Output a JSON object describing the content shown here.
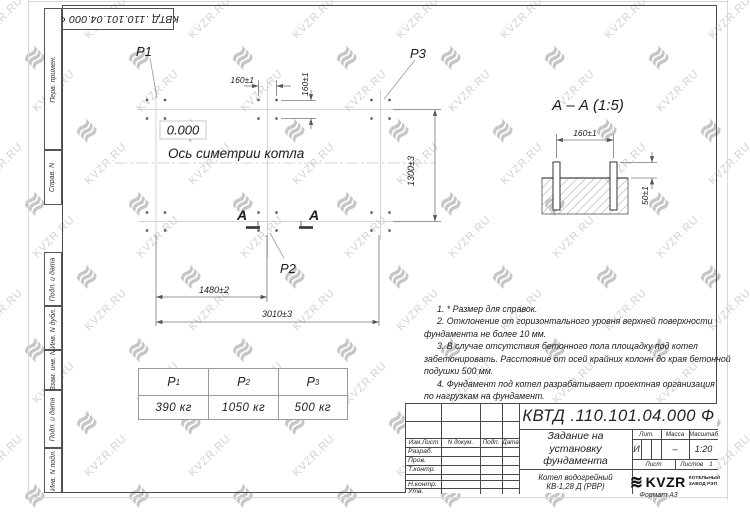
{
  "colors": {
    "line": "#4a4a4a",
    "watermark_text": "#d2d2d2",
    "watermark_logo": "#c6c6c6"
  },
  "watermark": {
    "text": "KVZR.RU",
    "logo_glyph": "≋"
  },
  "frame": {
    "left_labels": [
      "Перв. примен.",
      "Справ. N",
      "Подп. и дата",
      "Инв. N дубл.",
      "Взам. инв. N",
      "Подп. и дата",
      "Инв. N подл."
    ],
    "format_label": "Формат А3"
  },
  "plan": {
    "level_mark": "0.000",
    "axis_label": "Ось симетрии котла",
    "p1": "P1",
    "p2": "P2",
    "p3": "P3",
    "section_letter": "А",
    "dims": {
      "bolt_h": "160±1",
      "bolt_v": "160±1",
      "width_part": "1480±2",
      "width_total": "3010±3",
      "height_total": "1300±3"
    }
  },
  "section": {
    "title": "А – А (1:5)",
    "dims": {
      "bolt_spacing": "160±1",
      "bolt_height": "50±1"
    }
  },
  "notes": {
    "lines": [
      "1. * Размер для справок.",
      "2. Отклонение от горизонтального уровня верхней поверхности",
      "фундамента не более 10 мм.",
      "3. В случае отсутствия бетонного пола площадку под котел",
      "забетонировать. Расстояние от осей крайних колонн до края бетонной",
      "подушки 500 мм.",
      "4. Фундамент под котел разрабатывает проектная организация",
      "по нагрузкам на фундамент."
    ]
  },
  "loads": {
    "columns": [
      {
        "head": "P",
        "sub": "1",
        "value": "390 кг"
      },
      {
        "head": "P",
        "sub": "2",
        "value": "1050 кг"
      },
      {
        "head": "P",
        "sub": "3",
        "value": "500 кг"
      }
    ]
  },
  "titleblock": {
    "number": "КВТД .110.101.04.000  Ф",
    "header_cols": [
      "Изм.Лист",
      "N докум.",
      "Подп.",
      "Дата"
    ],
    "row_labels": [
      "Разраб.",
      "Пров.",
      "Т.контр.",
      "",
      "Н.контр.",
      "Утв."
    ],
    "title_lines": [
      "Задание на",
      "установку",
      "фундамента"
    ],
    "product_lines": [
      "Котел водогрейный",
      "КВ-1,28 Д (РВР)"
    ],
    "lit_label": "Лит.",
    "mass_label": "Масса",
    "scale_label": "Масштаб",
    "lit_value": "И",
    "mass_value": "–",
    "scale_value": "1:20",
    "sheet_label": "Лист",
    "sheets_label": "Листов",
    "sheets_value": "1",
    "logo_text": "KVZR",
    "logo_line1": "КОТЕЛЬНЫЙ",
    "logo_line2": "ЗАВОД РЭП"
  }
}
